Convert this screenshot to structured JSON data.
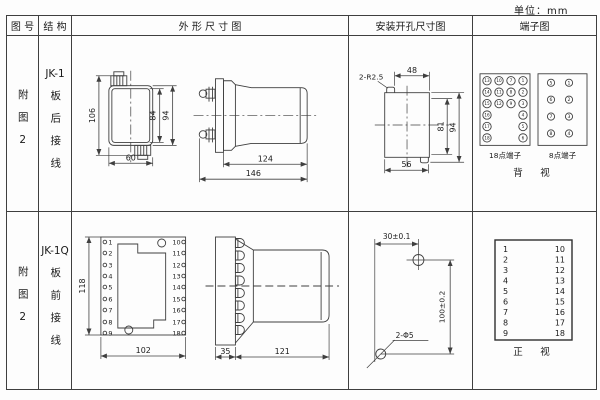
{
  "unit_label": "单位：mm",
  "header": {
    "fig_no": "图 号",
    "structure": "结 构",
    "outline": "外 形 尺 寸 图",
    "mounting": "安装开孔尺寸图",
    "terminal": "端子图"
  },
  "row1": {
    "fig_no": "附图2",
    "model": "JK-1",
    "wiring": "板后接线",
    "outline": {
      "front_height": "106",
      "inner_height": "84",
      "outer_height": "94",
      "width": "60",
      "body_length": "124",
      "total_length": "146"
    },
    "mounting": {
      "notch_radius": "2-R2.5",
      "top_width": "48",
      "inner_height": "81",
      "outer_height": "94",
      "bottom_width": "56"
    },
    "terminal18": {
      "label": "18点端子",
      "grid": [
        [
          "13",
          "10",
          "7",
          "1"
        ],
        [
          "14",
          "11",
          "8",
          "2"
        ],
        [
          "15",
          "12",
          "9",
          "3"
        ],
        [
          "16",
          "4"
        ],
        [
          "17",
          "5"
        ],
        [
          "18",
          "6"
        ]
      ]
    },
    "terminal8": {
      "label": "8点端子",
      "left": [
        "5",
        "6",
        "7",
        "8"
      ],
      "right": [
        "1",
        "2",
        "3",
        "4"
      ]
    },
    "view_label": "背　视"
  },
  "row2": {
    "fig_no": "附图2",
    "model": "JK-1Q",
    "wiring": "板前接线",
    "outline": {
      "height": "118",
      "width": "102",
      "plate_depth": "35",
      "body_length": "121",
      "left_terminals": [
        "1",
        "2",
        "3",
        "4",
        "5",
        "6",
        "7",
        "8",
        "9"
      ],
      "right_terminals": [
        "10",
        "11",
        "12",
        "13",
        "14",
        "15",
        "16",
        "17",
        "18"
      ]
    },
    "mounting": {
      "hole_spacing_x": "30±0.1",
      "hole_spacing_y": "100±0.2",
      "hole_spec": "2-Φ5"
    },
    "terminal": {
      "left": [
        "1",
        "2",
        "3",
        "4",
        "5",
        "6",
        "7",
        "8",
        "9"
      ],
      "right": [
        "10",
        "11",
        "12",
        "13",
        "14",
        "15",
        "16",
        "17",
        "18"
      ],
      "view_label": "正　视"
    }
  }
}
